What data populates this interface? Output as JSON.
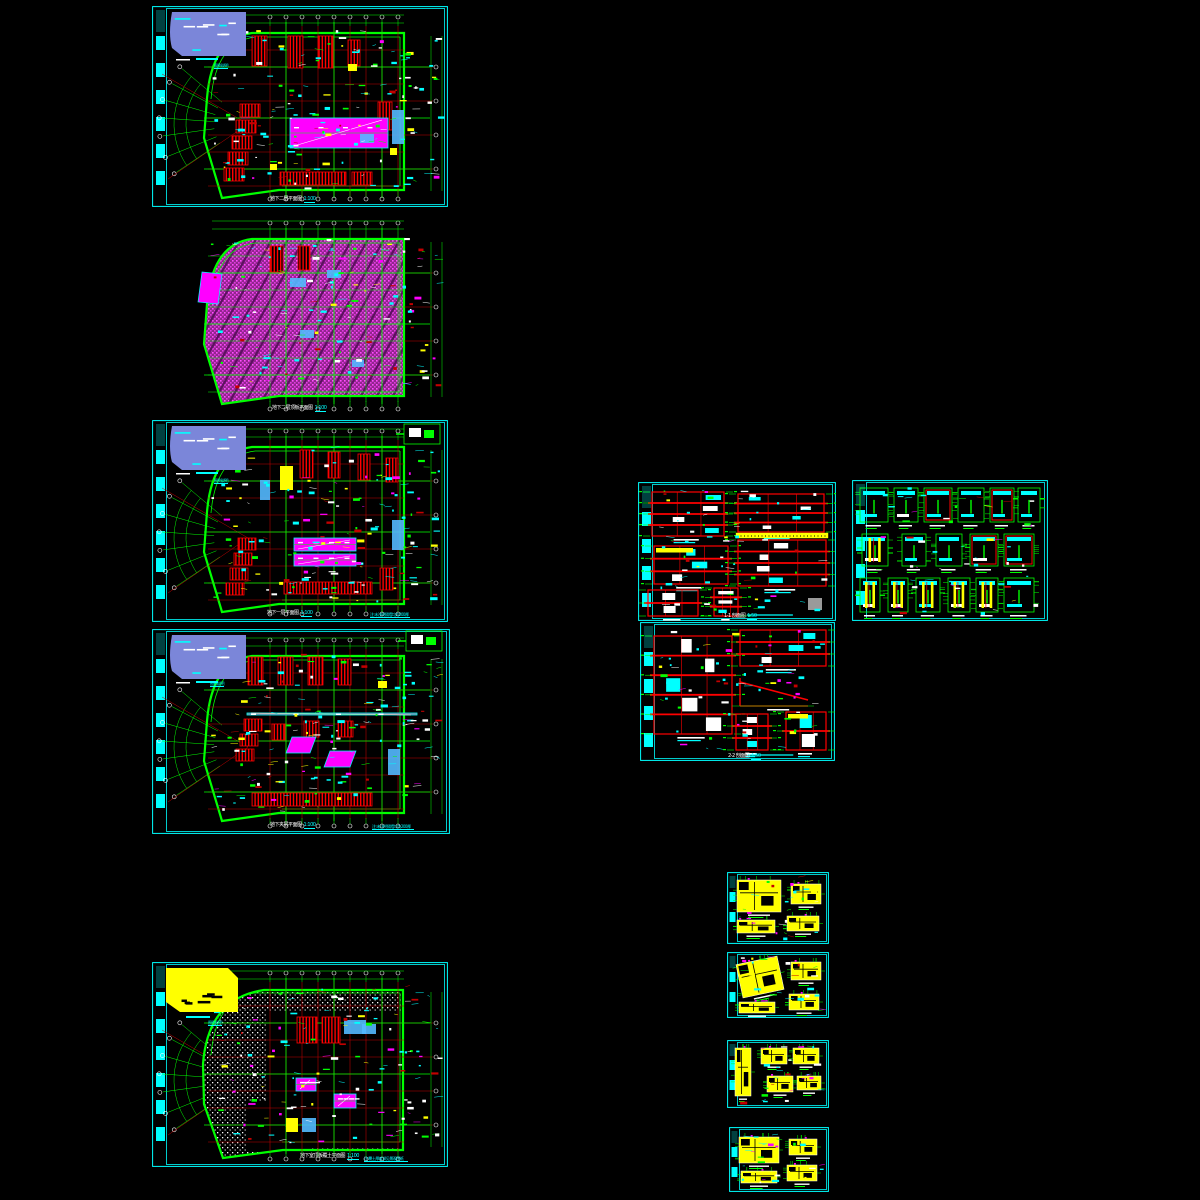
{
  "app": {
    "background": "#000000",
    "description": "CAD drawing set - basement plans, wall sections and detail sheets"
  },
  "palette": {
    "border_cyan": "#00ffff",
    "green": "#00ff00",
    "red": "#ff0000",
    "dark_red": "#c40000",
    "magenta": "#ff00ff",
    "hatch_magenta": "#a828a8",
    "cyan": "#00ffff",
    "yellow": "#ffff00",
    "white": "#ffffff",
    "violet_legend": "#7b86d9",
    "light_blue": "#53b9ff",
    "gray": "#9a9a9a"
  },
  "sheets": [
    {
      "id": "plan-b2",
      "title": "地下二层平面图",
      "scale": "1:100",
      "legend_label": "图例说明"
    },
    {
      "id": "plan-b2-roof",
      "title": "地下二层顶板平面图",
      "scale": "1:100"
    },
    {
      "id": "plan-b1",
      "title": "地下一层平面图",
      "scale": "1:100",
      "legend_label": "图例说明",
      "note": "注:未注明隔墙均为200厚"
    },
    {
      "id": "plan-b1-mez",
      "title": "地下夹层平面图",
      "scale": "1:100",
      "legend_label": "图例说明",
      "note": "注:未注明隔墙均为200厚"
    },
    {
      "id": "plan-top-slab",
      "title": "地下室顶板覆土平面图",
      "scale": "1:100",
      "legend_label": "图例说明",
      "note": "注:覆土厚度详见景观图纸"
    },
    {
      "id": "sections-1",
      "title": "1-1 剖面图",
      "scale": "1:50"
    },
    {
      "id": "stair-details",
      "title": "楼梯间详图",
      "scale": "1:50"
    },
    {
      "id": "sections-2",
      "title": "2-2 剖面图",
      "scale": "1:50"
    },
    {
      "id": "detail-a",
      "title": "卫生间大样 一"
    },
    {
      "id": "detail-b",
      "title": "卫生间大样 二"
    },
    {
      "id": "detail-c",
      "title": "卫生间大样 三"
    },
    {
      "id": "detail-d",
      "title": "卫生间大样 四"
    }
  ]
}
